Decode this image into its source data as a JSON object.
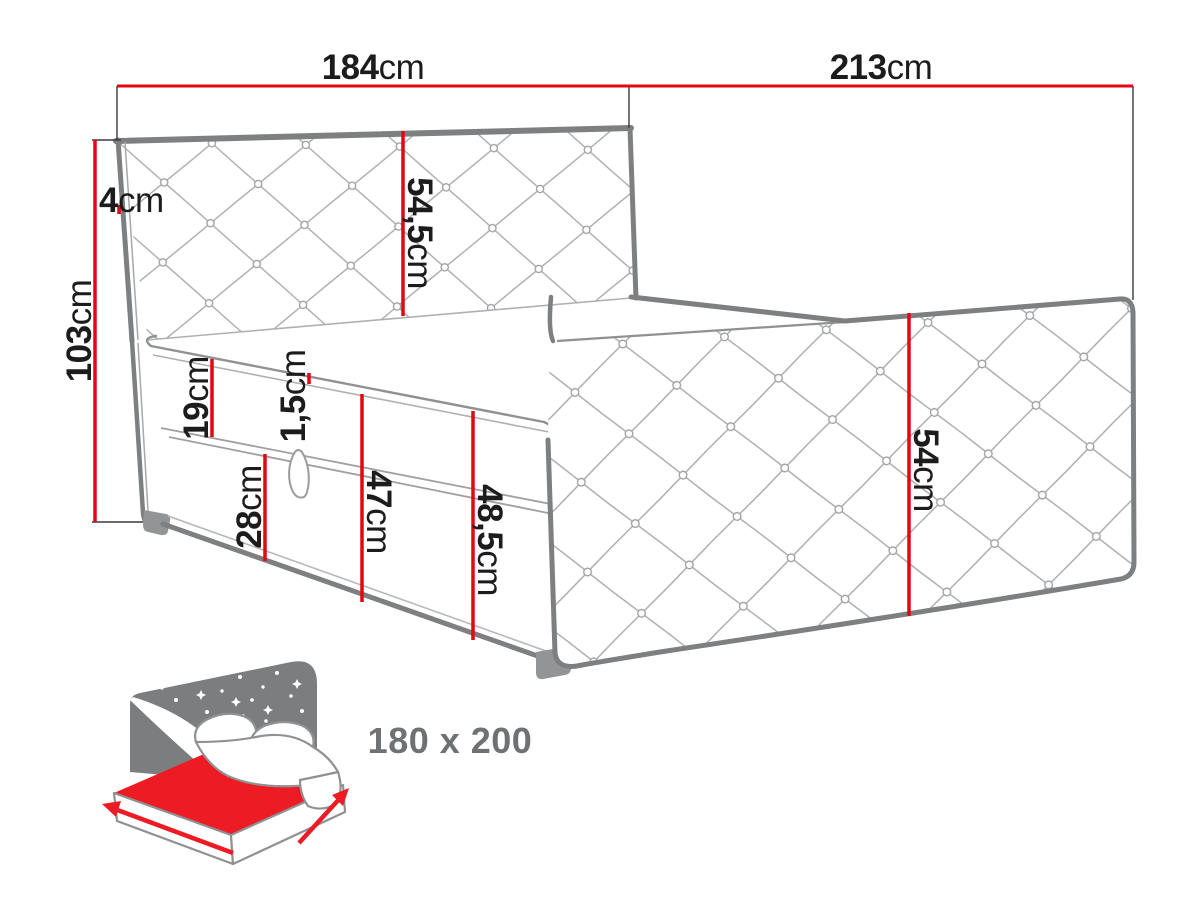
{
  "title": "Bed dimension diagram",
  "colors": {
    "dimension_red": "#e30613",
    "outline_gray": "#7d7f80",
    "detail_gray": "#a6a8aa",
    "text_black": "#1c1c1c",
    "icon_gray": "#7b7d7e",
    "icon_red": "#ed1c24",
    "size_text_gray": "#6f7173",
    "background": "#ffffff"
  },
  "dimensions": {
    "headboard_width": {
      "value": "184",
      "unit": "cm"
    },
    "bed_length": {
      "value": "213",
      "unit": "cm"
    },
    "headboard_height": {
      "value": "103",
      "unit": "cm"
    },
    "headboard_thickness": {
      "value": "4",
      "unit": "cm"
    },
    "headboard_panel_height": {
      "value": "54,5",
      "unit": "cm"
    },
    "mattress_height": {
      "value": "19",
      "unit": "cm"
    },
    "topper_thickness": {
      "value": "1,5",
      "unit": "cm"
    },
    "storage_height": {
      "value": "28",
      "unit": "cm"
    },
    "base_height": {
      "value": "47",
      "unit": "cm"
    },
    "base_total_height": {
      "value": "48,5",
      "unit": "cm"
    },
    "side_panel_height": {
      "value": "54",
      "unit": "cm"
    }
  },
  "size_badge": {
    "label": "180 x 200"
  }
}
